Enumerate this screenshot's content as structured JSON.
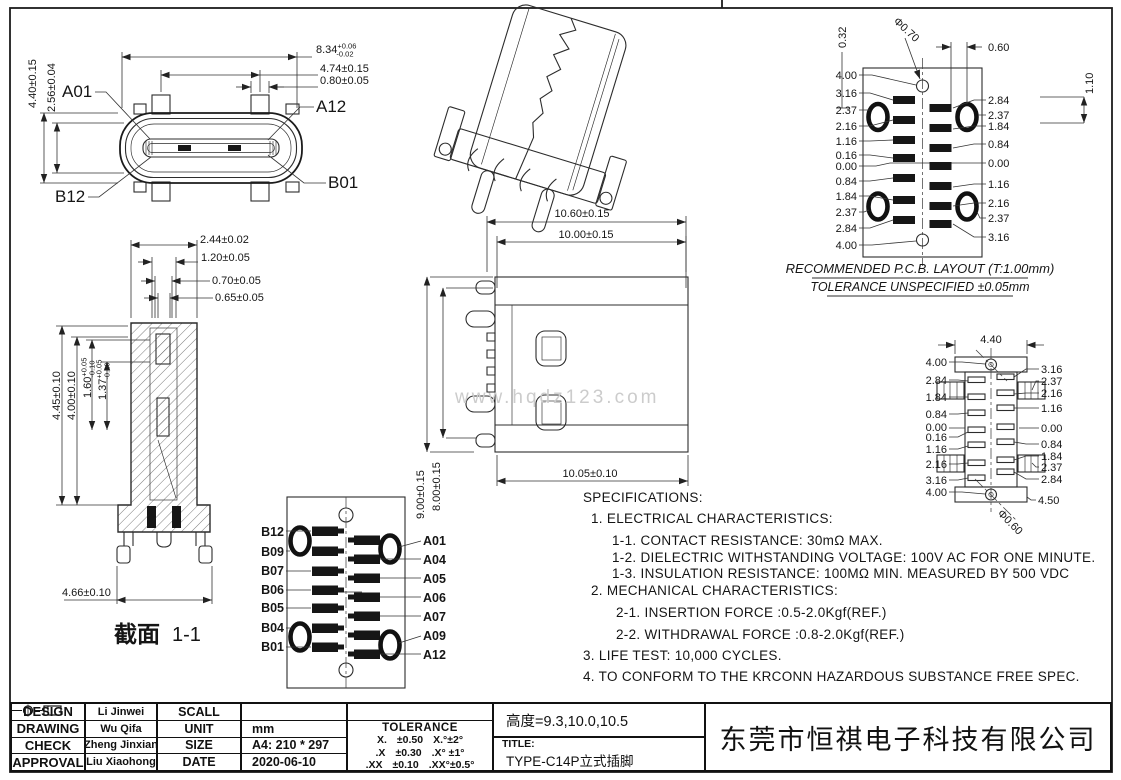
{
  "front_view": {
    "pin_a01": "A01",
    "pin_a12": "A12",
    "pin_b01": "B01",
    "pin_b12": "B12",
    "dim_width": {
      "v": "8.34",
      "p": "+0.06",
      "m": "-0.02"
    },
    "dim_pitch": "4.74±0.15",
    "dim_pin": "0.80±0.05",
    "dim_height": "4.40±0.15",
    "dim_inner": "2.56±0.04"
  },
  "section_view": {
    "caption": "截面",
    "caption_num": "1-1",
    "dim_t1": "2.44±0.02",
    "dim_t2": "1.20±0.05",
    "dim_t3": "0.70±0.05",
    "dim_t4": "0.65±0.05",
    "dim_l1": "4.45±0.10",
    "dim_l2": "4.00±0.10",
    "dim_l3": {
      "v": "1.60",
      "p": "+0.05",
      "m": "-0.10"
    },
    "dim_l4": {
      "v": "1.37",
      "p": "+0.05",
      "m": "-0.10"
    },
    "dim_b": "4.66±0.10"
  },
  "side_view": {
    "dim_t1": "10.60±0.15",
    "dim_t2": "10.00±0.15",
    "dim_b": "10.05±0.10",
    "dim_v1": "9.00±0.15",
    "dim_v2": "8.00±0.15",
    "watermark": "www.hqdz123.com"
  },
  "pcb_top": {
    "left": [
      "4.00",
      "3.16",
      "2.37",
      "2.16",
      "1.16",
      "0.16",
      "0.00",
      "0.84",
      "1.84",
      "2.37",
      "2.84",
      "4.00"
    ],
    "right": [
      "2.84",
      "2.37",
      "1.84",
      "0.84",
      "0.00",
      "1.16",
      "2.16",
      "2.37",
      "3.16"
    ],
    "d_offset": "0.32",
    "d_hole": "Φ0.70",
    "d_span": "0.60",
    "d_pitch": "1.10",
    "caption1": "RECOMMENDED  P.C.B. LAYOUT (T:1.00mm)",
    "caption2": "TOLERANCE UNSPECIFIED ±0.05mm"
  },
  "pcb_bottom": {
    "d_width": "4.40",
    "d_hole": "Φ0.60",
    "d_edge": "4.50",
    "left": [
      "4.00",
      "2.84",
      "1.84",
      "0.84",
      "0.00",
      "0.16",
      "1.16",
      "2.16",
      "3.16",
      "4.00"
    ],
    "right": [
      "3.16",
      "2.37",
      "2.16",
      "1.16",
      "0.00",
      "0.84",
      "1.84",
      "2.37",
      "2.84"
    ]
  },
  "pinout": {
    "left": [
      "B12",
      "B09",
      "B07",
      "B06",
      "B05",
      "B04",
      "B01"
    ],
    "right": [
      "A01",
      "A04",
      "A05",
      "A06",
      "A07",
      "A09",
      "A12"
    ]
  },
  "specs": {
    "lines": [
      "SPECIFICATIONS:",
      "1. ELECTRICAL CHARACTERISTICS:",
      "1-1. CONTACT RESISTANCE: 30mΩ MAX.",
      "1-2. DIELECTRIC WITHSTANDING VOLTAGE: 100V AC FOR ONE MINUTE.",
      "1-3. INSULATION RESISTANCE: 100MΩ MIN. MEASURED BY 500 VDC",
      "2. MECHANICAL CHARACTERISTICS:",
      "2-1. INSERTION FORCE :0.5-2.0Kgf(REF.)",
      "2-2. WITHDRAWAL FORCE :0.8-2.0Kgf(REF.)",
      "3. LIFE TEST: 10,000 CYCLES.",
      "4. TO CONFORM TO THE KRCONN HAZARDOUS SUBSTANCE FREE SPEC."
    ]
  },
  "title_block": {
    "rows": [
      {
        "label": "DESIGN",
        "name": "Li Jinwei"
      },
      {
        "label": "DRAWING",
        "name": "Wu Qifa"
      },
      {
        "label": "CHECK",
        "name": "Zheng Jinxian"
      },
      {
        "label": "APPROVAL",
        "name": "Liu Xiaohong"
      }
    ],
    "meta": [
      {
        "label": "SCALL",
        "value": ""
      },
      {
        "label": "UNIT",
        "value": "mm"
      },
      {
        "label": "SIZE",
        "value": "A4: 210 * 297"
      },
      {
        "label": "DATE",
        "value": "2020-06-10"
      }
    ],
    "tolerance": {
      "header": "TOLERANCE",
      "rows": [
        [
          "X.",
          "±0.50",
          "X.°±2°"
        ],
        [
          ".X",
          "±0.30",
          ".X° ±1°"
        ],
        [
          ".XX",
          "±0.10",
          ".XX°±0.5°"
        ]
      ]
    },
    "height_note": "高度=9.3,10.0,10.5",
    "title_label": "TITLE:",
    "title_value": "TYPE-C14P立式插脚",
    "company": "东莞市恒祺电子科技有限公司"
  }
}
